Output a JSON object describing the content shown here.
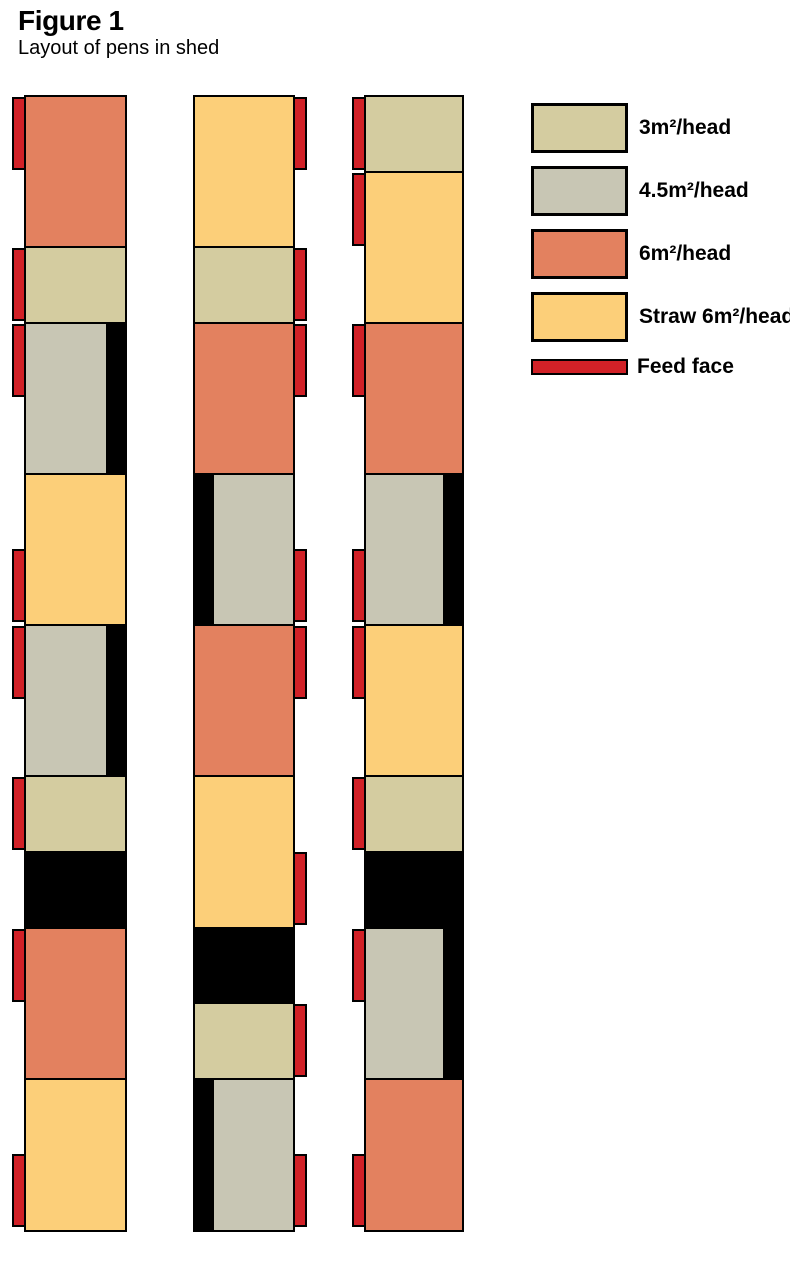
{
  "title": "Figure 1",
  "subtitle": "Layout of pens in shed",
  "colors": {
    "pen_3m": "#d4cca0",
    "pen_45m": "#c8c6b4",
    "pen_6m": "#e3815f",
    "straw": "#fccf79",
    "feed_face": "#d12127",
    "passage": "#000000"
  },
  "legend": [
    {
      "key": "pen_3m",
      "label": "3m²/head",
      "shape": "swatch"
    },
    {
      "key": "pen_45m",
      "label": "4.5m²/head",
      "shape": "swatch"
    },
    {
      "key": "pen_6m",
      "label": "6m²/head",
      "shape": "swatch"
    },
    {
      "key": "straw",
      "label": "Straw 6m²/head",
      "shape": "swatch"
    },
    {
      "key": "feed_face",
      "label": "Feed face",
      "shape": "bar"
    }
  ],
  "shed": {
    "columns": [
      {
        "name": "pen-row-1",
        "feed_side": "left",
        "segments": [
          {
            "type": "pen_6m",
            "span": 2,
            "feed": "top"
          },
          {
            "type": "pen_3m",
            "span": 1,
            "feed": "full"
          },
          {
            "type": "pen_45m",
            "span": 2,
            "feed": "top",
            "inner_black": "right"
          },
          {
            "type": "straw",
            "span": 2,
            "feed": "bottom"
          },
          {
            "type": "pen_45m",
            "span": 2,
            "feed": "top",
            "inner_black": "right"
          },
          {
            "type": "pen_3m",
            "span": 1,
            "feed": "full"
          },
          {
            "type": "passage",
            "span": 1
          },
          {
            "type": "pen_6m",
            "span": 2,
            "feed": "top"
          },
          {
            "type": "straw",
            "span": 2,
            "feed": "bottom"
          }
        ]
      },
      {
        "name": "pen-row-2",
        "feed_side": "right",
        "segments": [
          {
            "type": "straw",
            "span": 2,
            "feed": "top"
          },
          {
            "type": "pen_3m",
            "span": 1,
            "feed": "full"
          },
          {
            "type": "pen_6m",
            "span": 2,
            "feed": "top"
          },
          {
            "type": "pen_45m",
            "span": 2,
            "feed": "bottom",
            "inner_black": "left"
          },
          {
            "type": "pen_6m",
            "span": 2,
            "feed": "top"
          },
          {
            "type": "straw",
            "span": 2,
            "feed": "bottom"
          },
          {
            "type": "passage",
            "span": 1
          },
          {
            "type": "pen_3m",
            "span": 1,
            "feed": "full"
          },
          {
            "type": "pen_45m",
            "span": 2,
            "feed": "bottom",
            "inner_black": "left"
          }
        ]
      },
      {
        "name": "pen-row-3",
        "feed_side": "left",
        "segments": [
          {
            "type": "pen_3m",
            "span": 1,
            "feed": "full"
          },
          {
            "type": "straw",
            "span": 2,
            "feed": "top"
          },
          {
            "type": "pen_6m",
            "span": 2,
            "feed": "top"
          },
          {
            "type": "pen_45m",
            "span": 2,
            "feed": "bottom",
            "inner_black": "right"
          },
          {
            "type": "straw",
            "span": 2,
            "feed": "top"
          },
          {
            "type": "pen_3m",
            "span": 1,
            "feed": "full"
          },
          {
            "type": "passage",
            "span": 1
          },
          {
            "type": "pen_45m",
            "span": 2,
            "feed": "top",
            "inner_black": "right"
          },
          {
            "type": "pen_6m",
            "span": 2,
            "feed": "bottom"
          }
        ]
      }
    ]
  }
}
